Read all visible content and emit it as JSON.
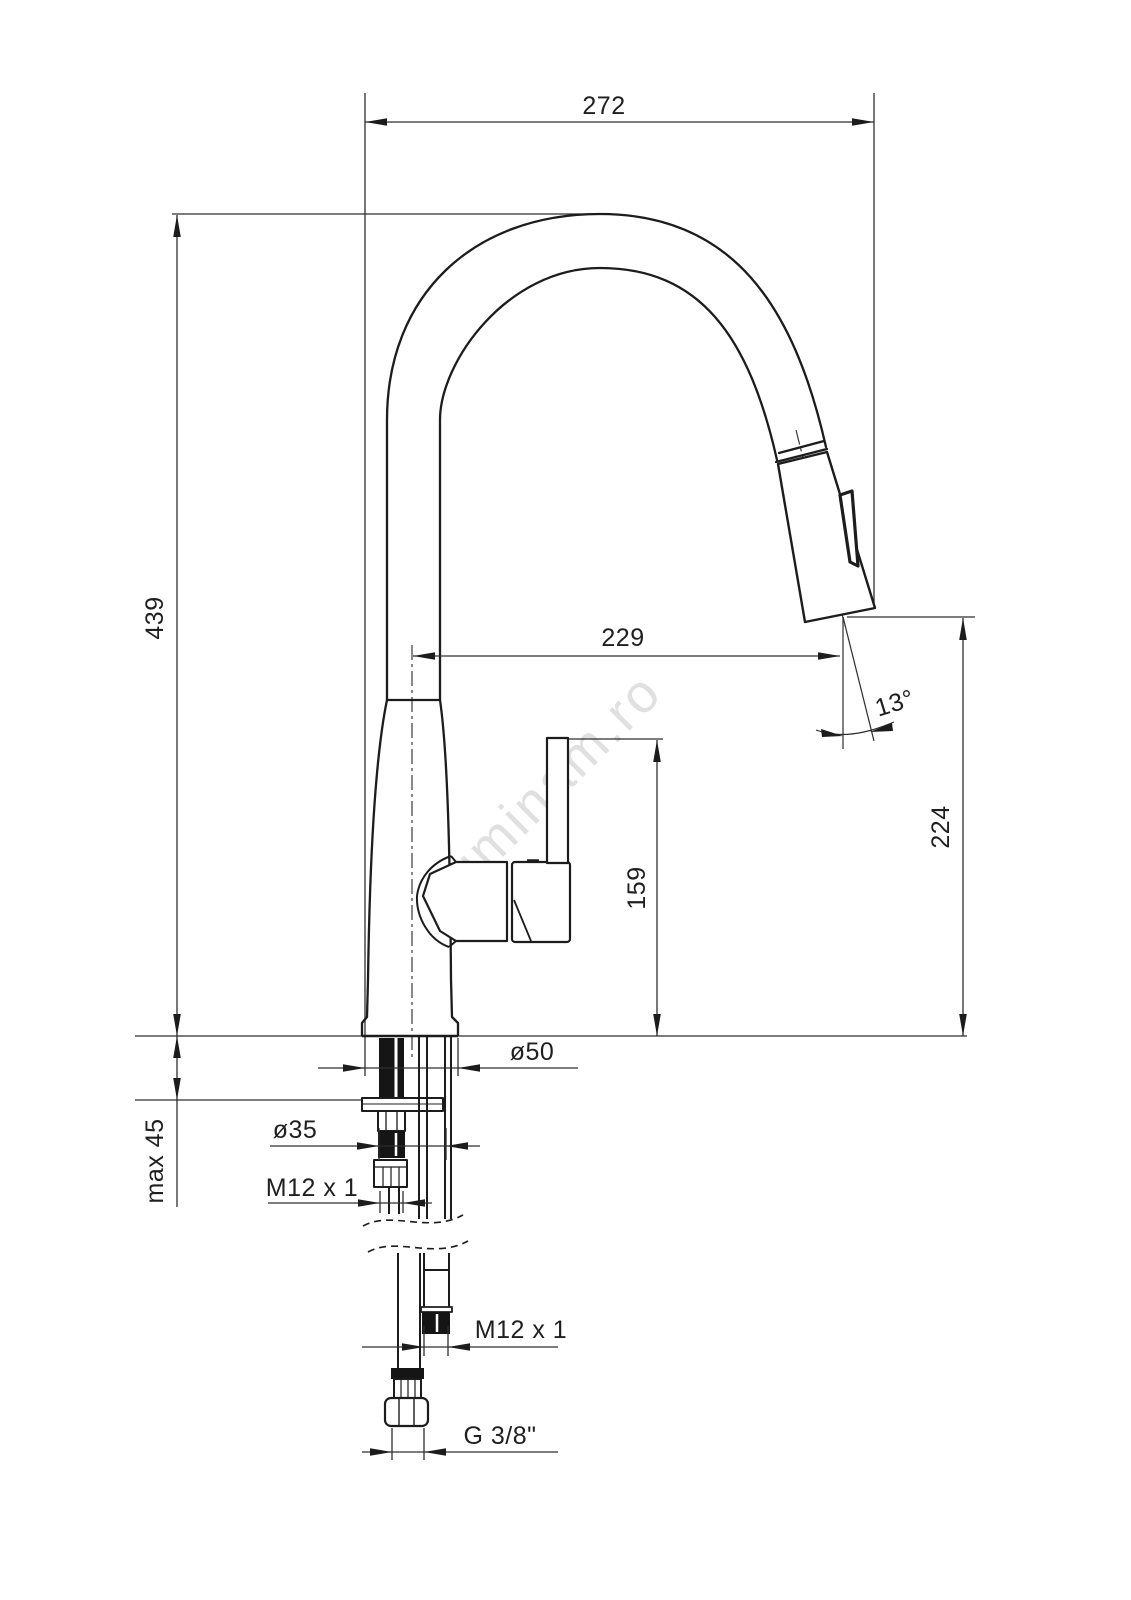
{
  "drawing": {
    "watermark": "luminam.ro",
    "labels": {
      "overall_width": "272",
      "overall_height": "439",
      "spout_reach": "229",
      "spray_angle": "13°",
      "outlet_height": "224",
      "handle_height": "159",
      "max_deck_thickness": "max 45",
      "base_diameter": "ø50",
      "hole_diameter": "ø35",
      "stud_thread": "M12 x 1",
      "hose_thread": "M12 x 1",
      "supply_connection": "G 3/8\""
    }
  }
}
